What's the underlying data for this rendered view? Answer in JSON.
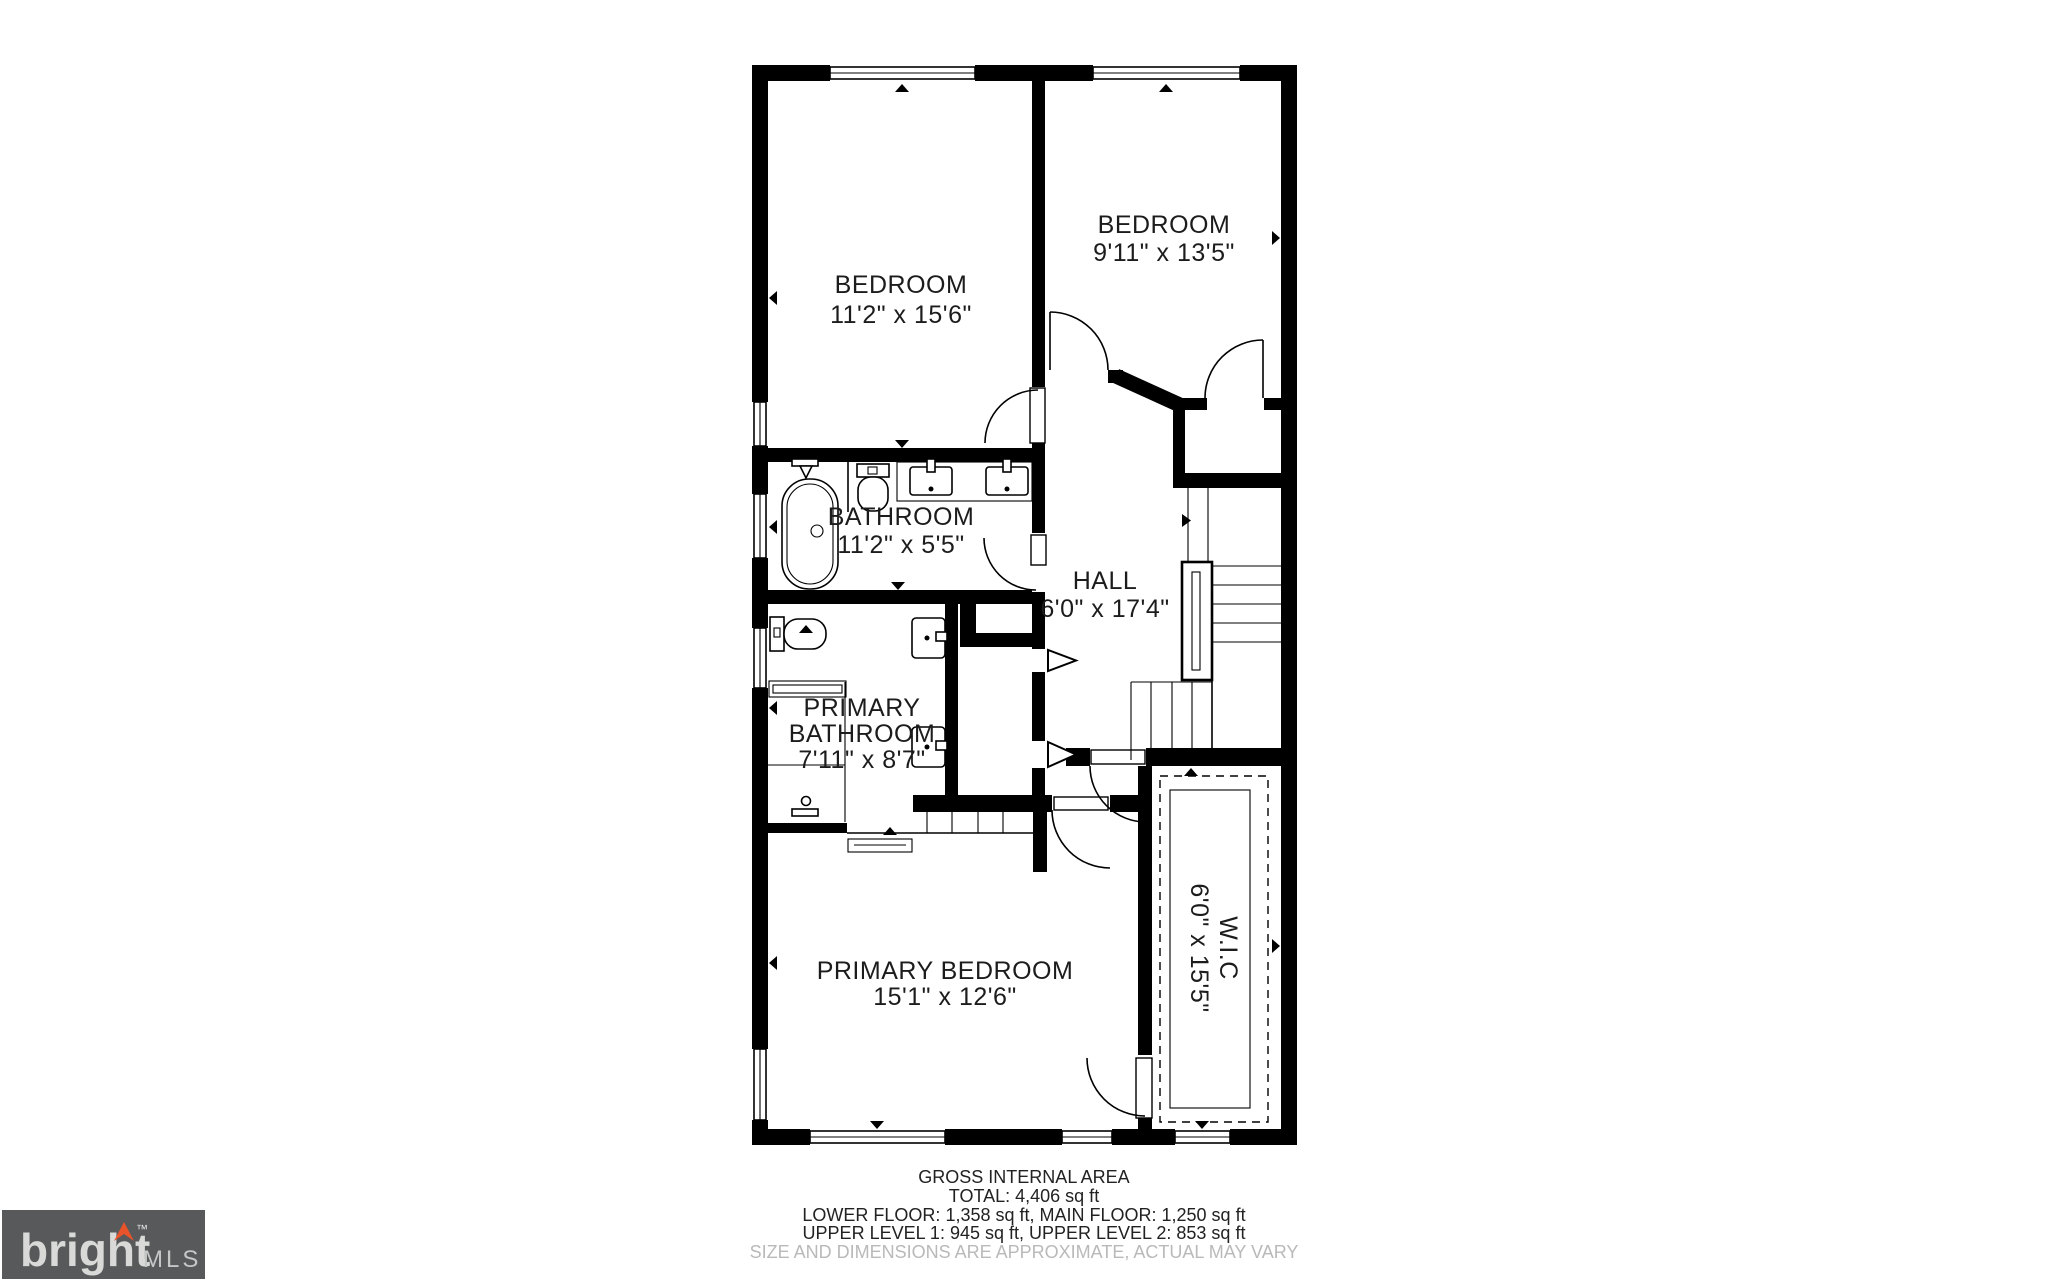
{
  "plan": {
    "rooms": {
      "bedroom1": {
        "name": "BEDROOM",
        "dims": "11'2\" x 15'6\""
      },
      "bedroom2": {
        "name": "BEDROOM",
        "dims": "9'11\" x 13'5\""
      },
      "bathroom": {
        "name": "BATHROOM",
        "dims": "11'2\" x 5'5\""
      },
      "hall": {
        "name": "HALL",
        "dims": "6'0\" x 17'4\""
      },
      "primary_bathroom": {
        "name_line1": "PRIMARY",
        "name_line2": "BATHROOM",
        "dims": "7'11\" x 8'7\""
      },
      "primary_bedroom": {
        "name": "PRIMARY BEDROOM",
        "dims": "15'1\" x 12'6\""
      },
      "wic": {
        "name": "W.I.C",
        "dims": "6'0\" x 15'5\""
      }
    }
  },
  "summary": {
    "title": "GROSS INTERNAL AREA",
    "total": "TOTAL: 4,406 sq ft",
    "floors1": "LOWER FLOOR: 1,358 sq ft, MAIN FLOOR: 1,250 sq ft",
    "floors2": "UPPER LEVEL 1: 945 sq ft, UPPER LEVEL 2: 853 sq ft",
    "disclaimer": "SIZE AND DIMENSIONS ARE APPROXIMATE, ACTUAL MAY VARY"
  },
  "logo": {
    "brand": "bright",
    "suffix": "MLS",
    "tm": "™"
  },
  "colors": {
    "wall": "#000000",
    "text": "#1c1c1c",
    "disclaimer": "#b9b9b9",
    "logo_bg": "#58595b",
    "logo_text": "#d9d9d7",
    "logo_mls": "#c5c7c6",
    "logo_accent": "#e8532a"
  }
}
